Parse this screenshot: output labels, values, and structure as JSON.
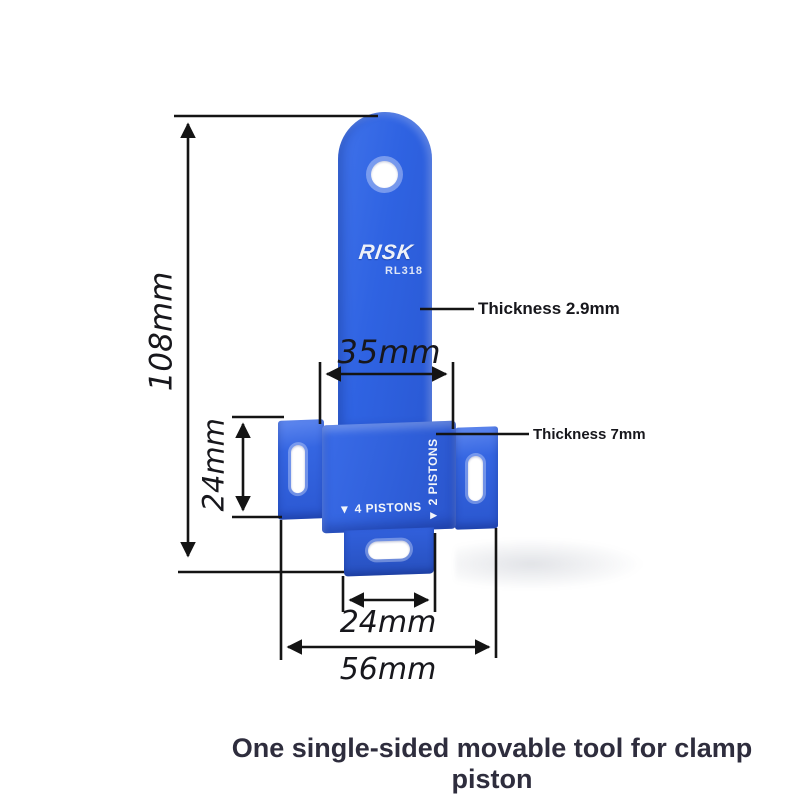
{
  "figure": {
    "brand": "RISK",
    "model": "RL318",
    "marking_4_pistons": "▼ 4 PISTONS",
    "marking_2_pistons": "▼ 2 PISTONS"
  },
  "annotations": {
    "overall_height": "108mm",
    "blade_width": "35mm",
    "wing_height": "24mm",
    "tab_width": "24mm",
    "overall_width": "56mm",
    "blade_thickness": "Thickness 2.9mm",
    "body_thickness": "Thickness 7mm"
  },
  "caption": "One single-sided movable tool for clamp piston",
  "colors": {
    "tool_blue": "#2f62e0",
    "dimension_line": "#141414",
    "caption_text": "#2e2d3d",
    "marking_text": "#f2f5fa"
  }
}
